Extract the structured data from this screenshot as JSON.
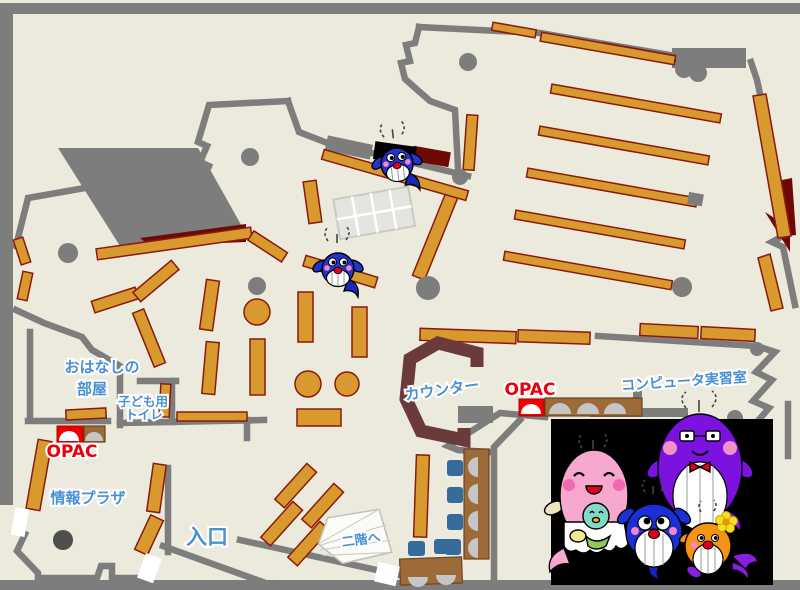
{
  "page": {
    "type": "library-floor-map",
    "floor": "1F"
  },
  "labels": {
    "storytelling_room_l1": "おはなしの",
    "storytelling_room_l2": "部屋",
    "kids_toilet_l1": "子ども用",
    "kids_toilet_l2": "トイレ",
    "opac_left": "OPAC",
    "opac_center": "OPAC",
    "info_plaza": "情報プラザ",
    "entrance": "入口",
    "counter": "カウンター",
    "computer_room": "コンピュータ実習室",
    "to_second_floor": "二階へ"
  },
  "colors": {
    "floor": "#ECEADC",
    "wall_gray": "#7D7D7D",
    "shelf_orange": "#D8992F",
    "shelf_border": "#8B1A0E",
    "accent_dark_red": "#6E0A05",
    "counter_brown": "#6B3A3A",
    "desk_brown": "#9C6B38",
    "chair_blue": "#366B9E",
    "label_blue": "#4A8FD4",
    "label_red": "#E8000F",
    "mascot_panel": "#000000",
    "father_purple": "#7C12DE",
    "mother_pink": "#F6A8CE",
    "child_blue": "#1C2ED6",
    "child_orange": "#F49414"
  },
  "mascots": {
    "family": [
      "father-purple-whale",
      "mother-pink-whale",
      "child-blue-whale",
      "child-orange-whale"
    ],
    "map_sprites": [
      "blue-whale-sprite-upper",
      "blue-whale-sprite-middle"
    ]
  }
}
